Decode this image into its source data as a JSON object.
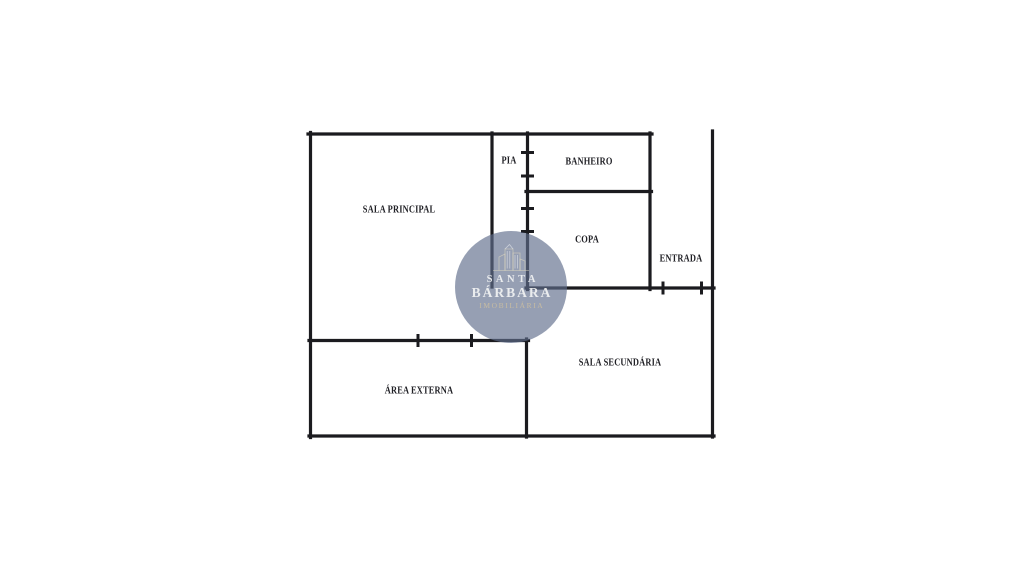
{
  "colors": {
    "wall-color": "#1b1b1f",
    "label-color": "#1f1f24",
    "wm-bg": "rgba(95,110,140,0.66)",
    "wm-text": "#f2f3f3",
    "wm-accent": "#cdbfa0"
  },
  "floorplan": {
    "rooms": {
      "sala_principal": "SALA PRINCIPAL",
      "pia": "PIA",
      "banheiro": "BANHEIRO",
      "copa": "COPA",
      "entrada": "ENTRADA",
      "sala_secundaria": "SALA SECUNDÁRIA",
      "area_externa": "ÁREA EXTERNA"
    }
  },
  "watermark": {
    "line1": "SANTA",
    "line2": "BÁRBARA",
    "line3": "IMOBILIÁRIA"
  }
}
